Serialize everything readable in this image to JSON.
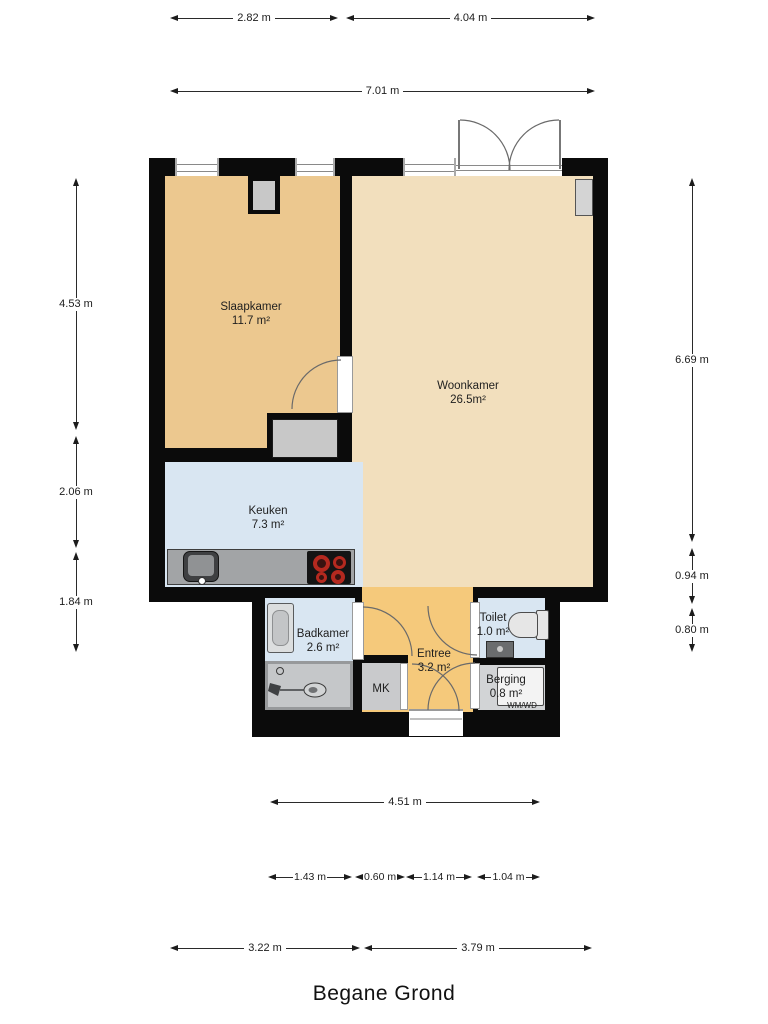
{
  "title": "Begane Grond",
  "rooms": {
    "slaapkamer": {
      "name": "Slaapkamer",
      "area": "11.7 m²"
    },
    "woonkamer": {
      "name": "Woonkamer",
      "area": "26.5m²"
    },
    "keuken": {
      "name": "Keuken",
      "area": "7.3 m²"
    },
    "badkamer": {
      "name": "Badkamer",
      "area": "2.6 m²"
    },
    "entree": {
      "name": "Entree",
      "area": "3.2 m²"
    },
    "toilet": {
      "name": "Toilet",
      "area": "1.0 m²"
    },
    "berging": {
      "name": "Berging",
      "area": "0.8 m²"
    }
  },
  "fixtures": {
    "mk": "MK",
    "wmwd": "WM/WD"
  },
  "dimensions": {
    "top_row": [
      "2.82 m",
      "4.04 m"
    ],
    "top_total": "7.01 m",
    "left": [
      "4.53 m",
      "2.06 m",
      "1.84 m"
    ],
    "right": [
      "6.69 m",
      "0.94 m",
      "0.80 m"
    ],
    "bottom_total": "4.51 m",
    "bottom_chain": [
      "1.43 m",
      "0.60 m",
      "1.14 m",
      "1.04 m"
    ],
    "bottom_row": [
      "3.22 m",
      "3.79 m"
    ]
  },
  "colors": {
    "wall": "#0b0b0b",
    "slaapkamer_floor": "#ecc88f",
    "woonkamer_floor": "#f2dfbd",
    "entree_floor": "#f5c97b",
    "wet_room_floor": "#d9e6f2",
    "berging_floor": "#d2d4d6",
    "counter": "#a2a4a6",
    "burner_red": "#b5291f"
  }
}
